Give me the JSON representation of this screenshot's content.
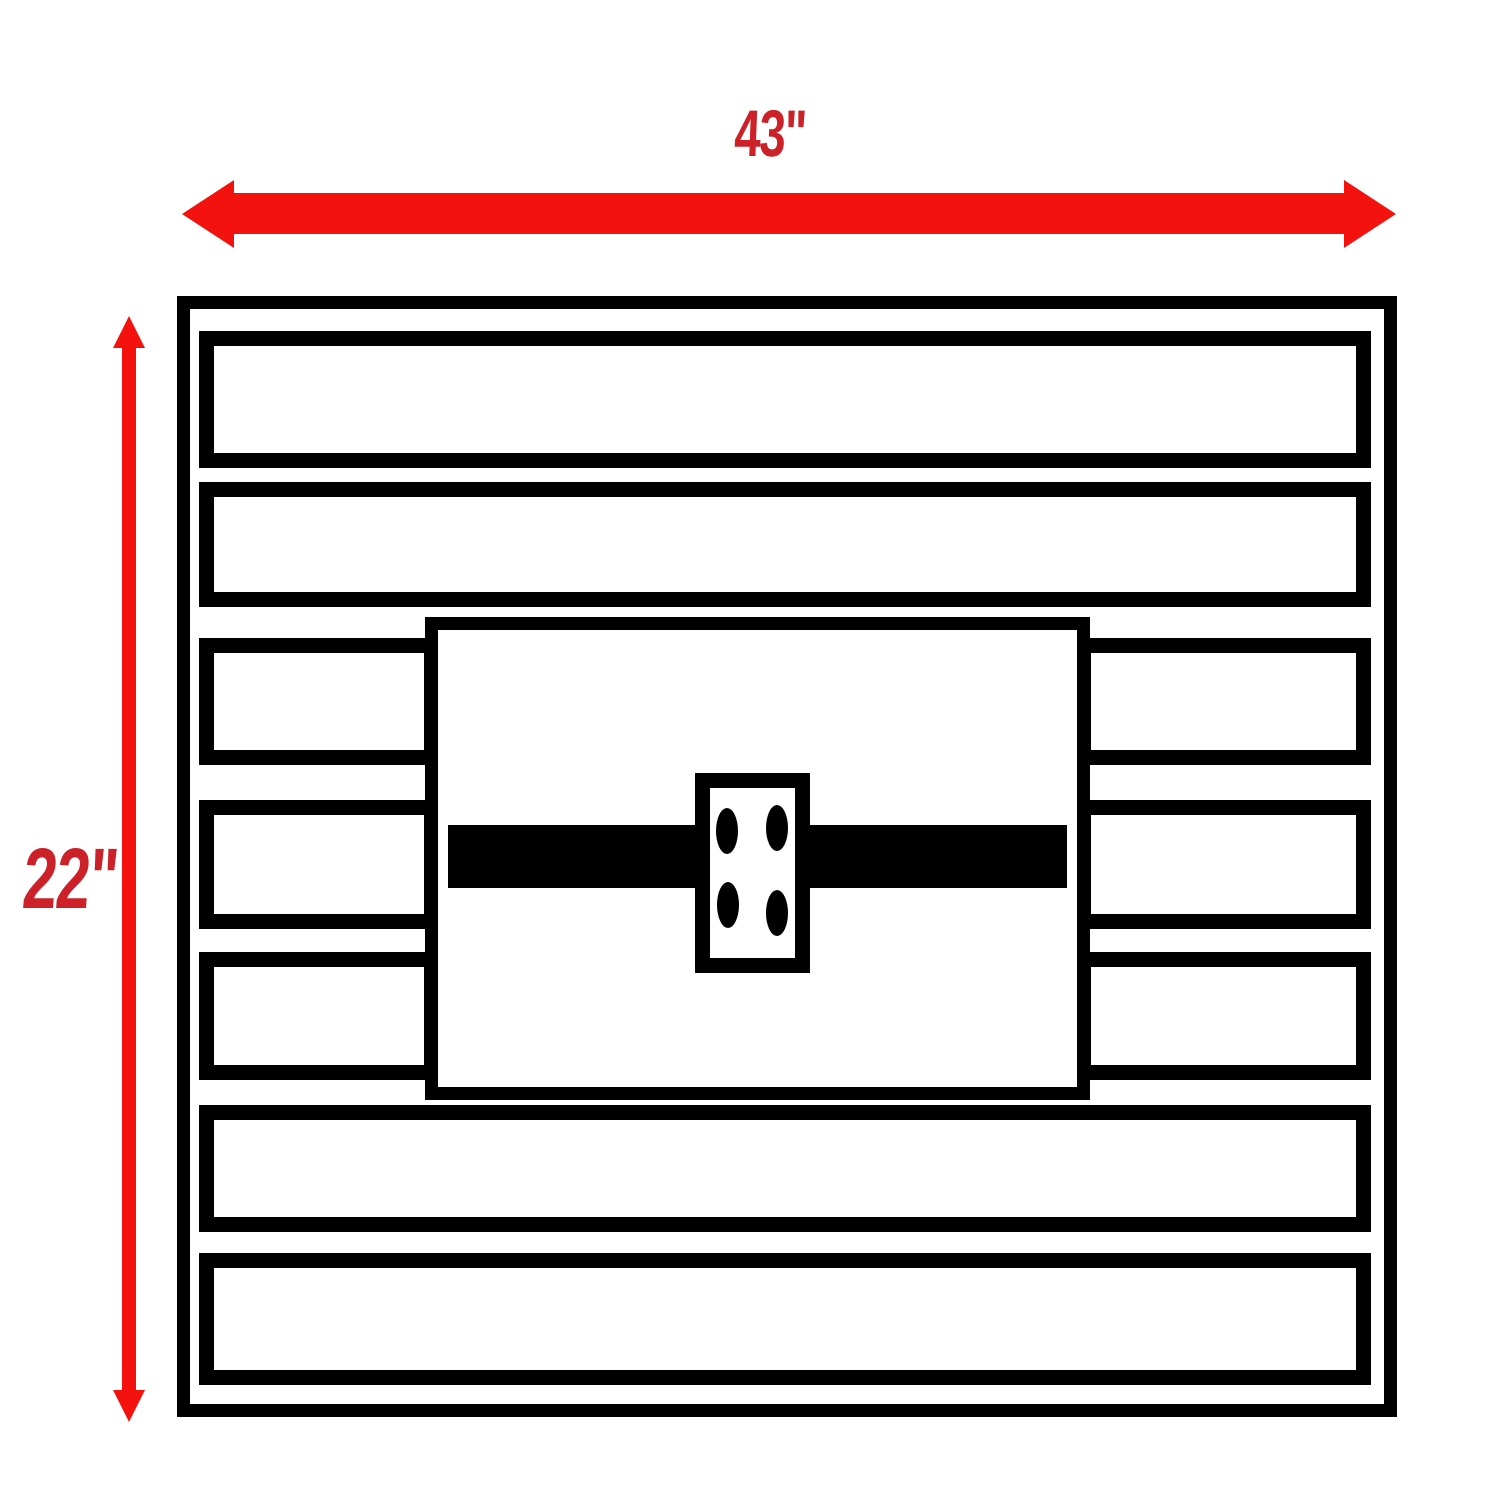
{
  "figure": {
    "type": "dimension-diagram",
    "subject": "slatted panel with center mounting plate, front view",
    "dimensions": {
      "width_label": "43\"",
      "height_label": "22\""
    },
    "colors": {
      "dimension_red": "#f3120e",
      "label_red": "#cc2128",
      "structure_black": "#000000",
      "background": "#ffffff"
    }
  }
}
